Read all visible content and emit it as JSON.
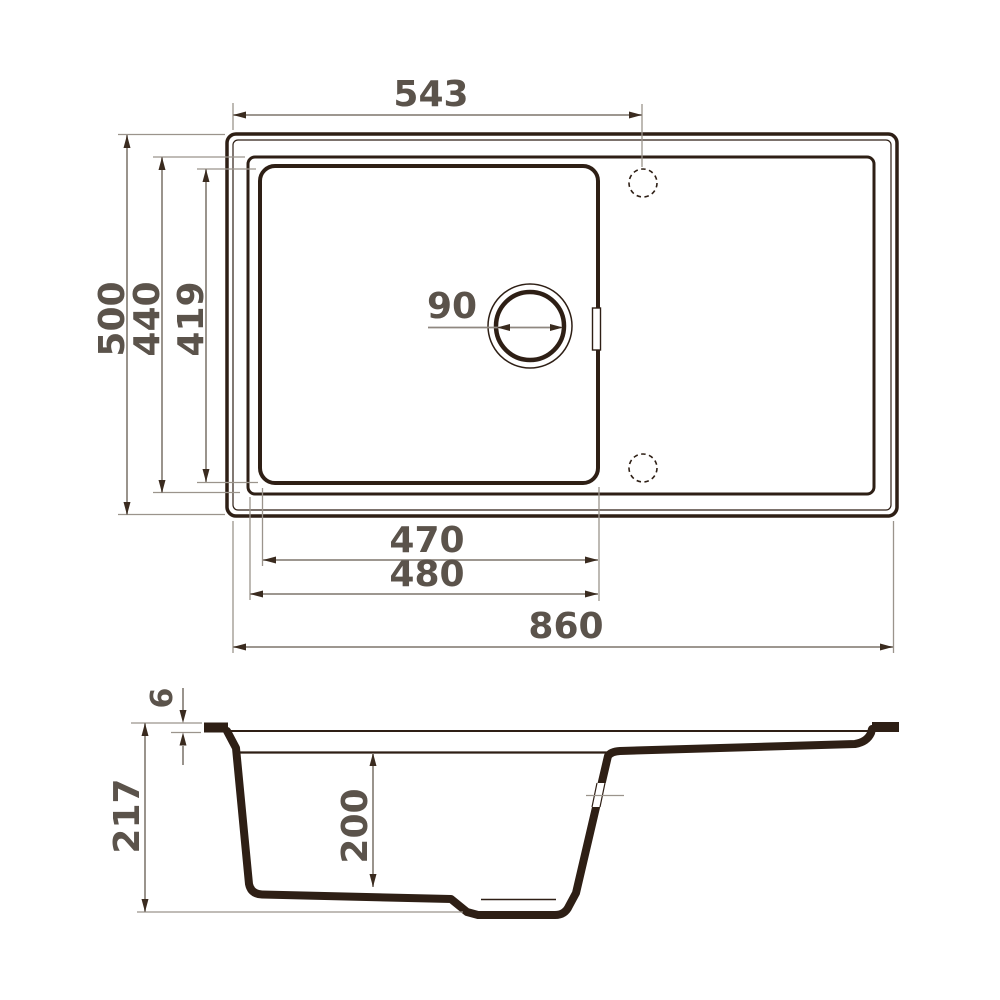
{
  "title": "Kitchen sink dimensional drawing",
  "colors": {
    "outline": "#2e1f15",
    "dimension_line": "#8f8880",
    "extension_line": "#9b948c",
    "arrow": "#3a2b1f",
    "label_text": "#5b534b",
    "background": "#ffffff"
  },
  "top_view": {
    "dimensions": {
      "tap_hole_offset": "543",
      "overall_width": "860",
      "overall_depth": "500",
      "rim_depth": "440",
      "bowl_inner_depth": "419",
      "bowl_inner_width": "470",
      "bowl_outer_width": "480",
      "drain_diameter": "90"
    }
  },
  "side_view": {
    "dimensions": {
      "overall_height": "217",
      "bowl_depth": "200",
      "rim_thickness": "6"
    }
  }
}
